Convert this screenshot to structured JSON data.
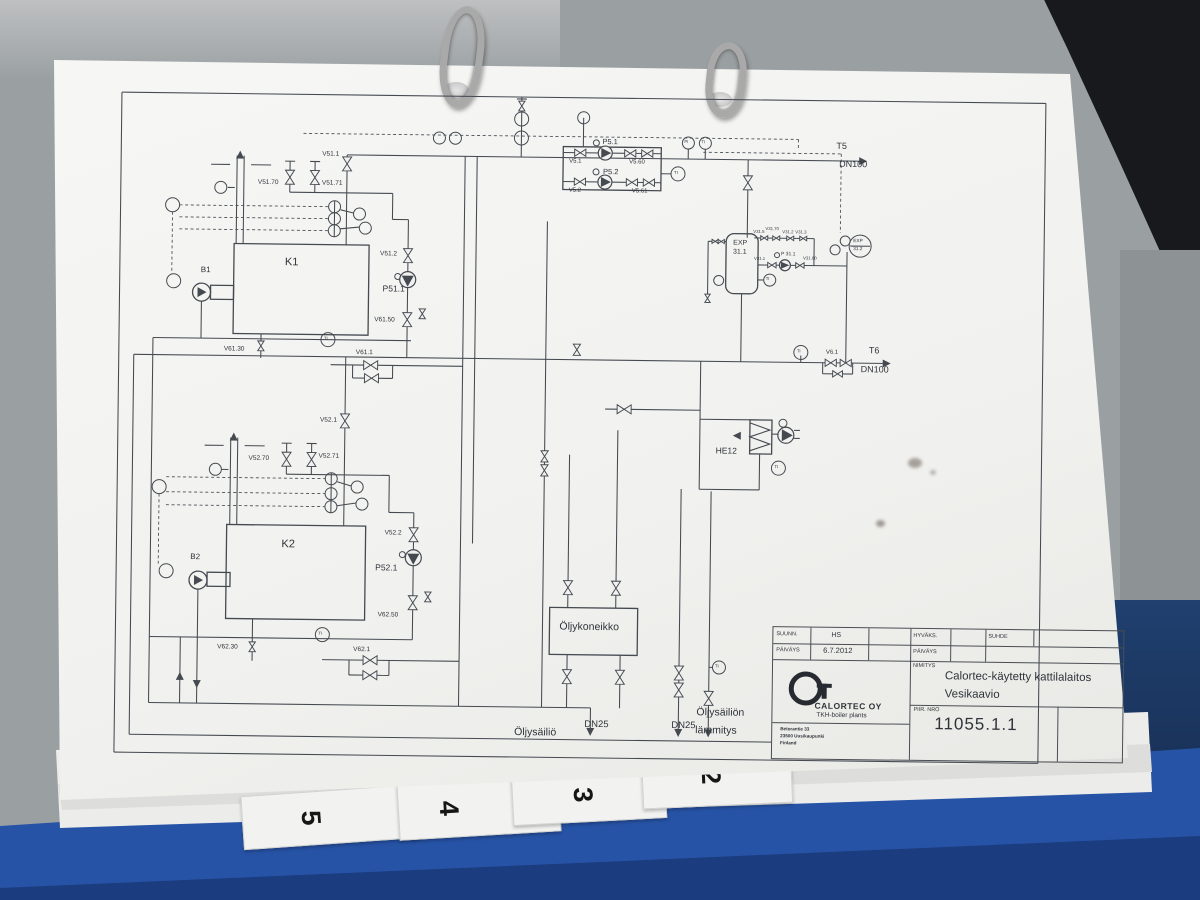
{
  "binder": {
    "tabs": [
      "5",
      "4",
      "3",
      "2"
    ]
  },
  "title_block": {
    "rows": {
      "suunn_label": "SUUNN.",
      "suunn_value": "HS",
      "paivays_label": "PÄIVÄYS",
      "paivays_value": "6.7.2012",
      "hyvaks_label": "HYVÄKS.",
      "hyvaks_paivays_label": "PÄIVÄYS",
      "suhde_label": "SUHDE",
      "nimitys_label": "NIMITYS",
      "piir_nro_label": "PIIR. NRO"
    },
    "company": "CALORTEC OY",
    "company_sub": "TKH-boiler plants",
    "address_lines": [
      "Betorantie 33",
      "23500 Uusikaupunki",
      "Finland"
    ],
    "project_title": "Calortec-käytetty kattilalaitos",
    "drawing_title": "Vesikaavio",
    "drawing_number": "11055.1.1"
  },
  "diagram": {
    "labels": [
      {
        "t": "K1",
        "x": 283,
        "y": 261,
        "s": 11
      },
      {
        "t": "K2",
        "x": 283,
        "y": 543,
        "s": 11
      },
      {
        "t": "B1",
        "x": 199,
        "y": 271,
        "s": 8
      },
      {
        "t": "B2",
        "x": 192,
        "y": 558,
        "s": 8
      },
      {
        "t": "V51.1",
        "x": 319,
        "y": 155,
        "s": 6.5
      },
      {
        "t": "V51.70",
        "x": 255,
        "y": 184,
        "s": 6.5
      },
      {
        "t": "V51.71",
        "x": 319,
        "y": 184,
        "s": 6.5
      },
      {
        "t": "V51.2",
        "x": 378,
        "y": 254,
        "s": 6.5
      },
      {
        "t": "P51.1",
        "x": 381,
        "y": 287,
        "s": 8.5
      },
      {
        "t": "V61.50",
        "x": 373,
        "y": 320,
        "s": 6.5
      },
      {
        "t": "V61.30",
        "x": 223,
        "y": 351,
        "s": 6.5
      },
      {
        "t": "V61.1",
        "x": 355,
        "y": 353,
        "s": 6.5
      },
      {
        "t": "V52.1",
        "x": 320,
        "y": 421,
        "s": 6.5
      },
      {
        "t": "V52.70",
        "x": 249,
        "y": 460,
        "s": 6.5
      },
      {
        "t": "V52.71",
        "x": 319,
        "y": 457,
        "s": 6.5
      },
      {
        "t": "V52.2",
        "x": 386,
        "y": 533,
        "s": 6.5
      },
      {
        "t": "P52.1",
        "x": 377,
        "y": 566,
        "s": 8.5
      },
      {
        "t": "V62.50",
        "x": 380,
        "y": 615,
        "s": 6.5
      },
      {
        "t": "V62.30",
        "x": 220,
        "y": 649,
        "s": 6.5
      },
      {
        "t": "V62.1",
        "x": 356,
        "y": 650,
        "s": 6.5
      },
      {
        "t": "P5.1",
        "x": 599,
        "y": 138,
        "s": 7.5
      },
      {
        "t": "P5.2",
        "x": 600,
        "y": 168,
        "s": 7.5
      },
      {
        "t": "V5.1",
        "x": 566,
        "y": 159,
        "s": 6
      },
      {
        "t": "V5.60",
        "x": 626,
        "y": 159,
        "s": 6
      },
      {
        "t": "V5.2",
        "x": 566,
        "y": 188,
        "s": 6
      },
      {
        "t": "V5.61",
        "x": 629,
        "y": 188,
        "s": 6
      },
      {
        "t": "T5",
        "x": 833,
        "y": 139,
        "s": 9
      },
      {
        "t": "DN100",
        "x": 836,
        "y": 157,
        "s": 9
      },
      {
        "t": "T6",
        "x": 868,
        "y": 343,
        "s": 9
      },
      {
        "t": "DN100",
        "x": 860,
        "y": 362,
        "s": 9
      },
      {
        "t": "V6.1",
        "x": 825,
        "y": 347,
        "s": 6
      },
      {
        "t": "EXP",
        "x": 731,
        "y": 238,
        "s": 7
      },
      {
        "t": "31.1",
        "x": 731,
        "y": 247,
        "s": 7
      },
      {
        "t": "V31.5",
        "x": 751,
        "y": 228,
        "s": 4.3
      },
      {
        "t": "V31.70",
        "x": 763,
        "y": 225,
        "s": 4.3
      },
      {
        "t": "V31.2",
        "x": 780,
        "y": 228,
        "s": 4.3
      },
      {
        "t": "V31.3",
        "x": 793,
        "y": 228,
        "s": 4.3
      },
      {
        "t": "V31.1",
        "x": 752,
        "y": 255,
        "s": 4.3
      },
      {
        "t": "P 31.1",
        "x": 779,
        "y": 250,
        "s": 5
      },
      {
        "t": "V31.60",
        "x": 801,
        "y": 254,
        "s": 4.3
      },
      {
        "t": "EXP",
        "x": 851,
        "y": 237,
        "s": 4.8
      },
      {
        "t": "31.2",
        "x": 851,
        "y": 245,
        "s": 4.8
      },
      {
        "t": "HE12",
        "x": 716,
        "y": 445,
        "s": 8.5
      },
      {
        "t": "Öljykoneikko",
        "x": 562,
        "y": 622,
        "s": 10.5
      },
      {
        "t": "Öljysäiliö",
        "x": 518,
        "y": 728,
        "s": 10.5
      },
      {
        "t": "DN25",
        "x": 588,
        "y": 720,
        "s": 9.5
      },
      {
        "t": "DN25",
        "x": 675,
        "y": 720,
        "s": 9.5
      },
      {
        "t": "Öljysäiliön",
        "x": 700,
        "y": 706,
        "s": 10.5
      },
      {
        "t": "lämmitys",
        "x": 699,
        "y": 724,
        "s": 10.5
      },
      {
        "t": "TI",
        "x": 323,
        "y": 340,
        "s": 4.2
      },
      {
        "t": "TI",
        "x": 321,
        "y": 635,
        "s": 4.2
      },
      {
        "t": "TI",
        "x": 775,
        "y": 463,
        "s": 4.2
      },
      {
        "t": "TI",
        "x": 796,
        "y": 347,
        "s": 4.2
      },
      {
        "t": "TI",
        "x": 671,
        "y": 170,
        "s": 4.2
      },
      {
        "t": "TI",
        "x": 764,
        "y": 275,
        "s": 4.2
      },
      {
        "t": "TI",
        "x": 718,
        "y": 663,
        "s": 4.2
      },
      {
        "t": "PI",
        "x": 681,
        "y": 139,
        "s": 4.2
      },
      {
        "t": "TI",
        "x": 698,
        "y": 139,
        "s": 4.2
      }
    ]
  }
}
